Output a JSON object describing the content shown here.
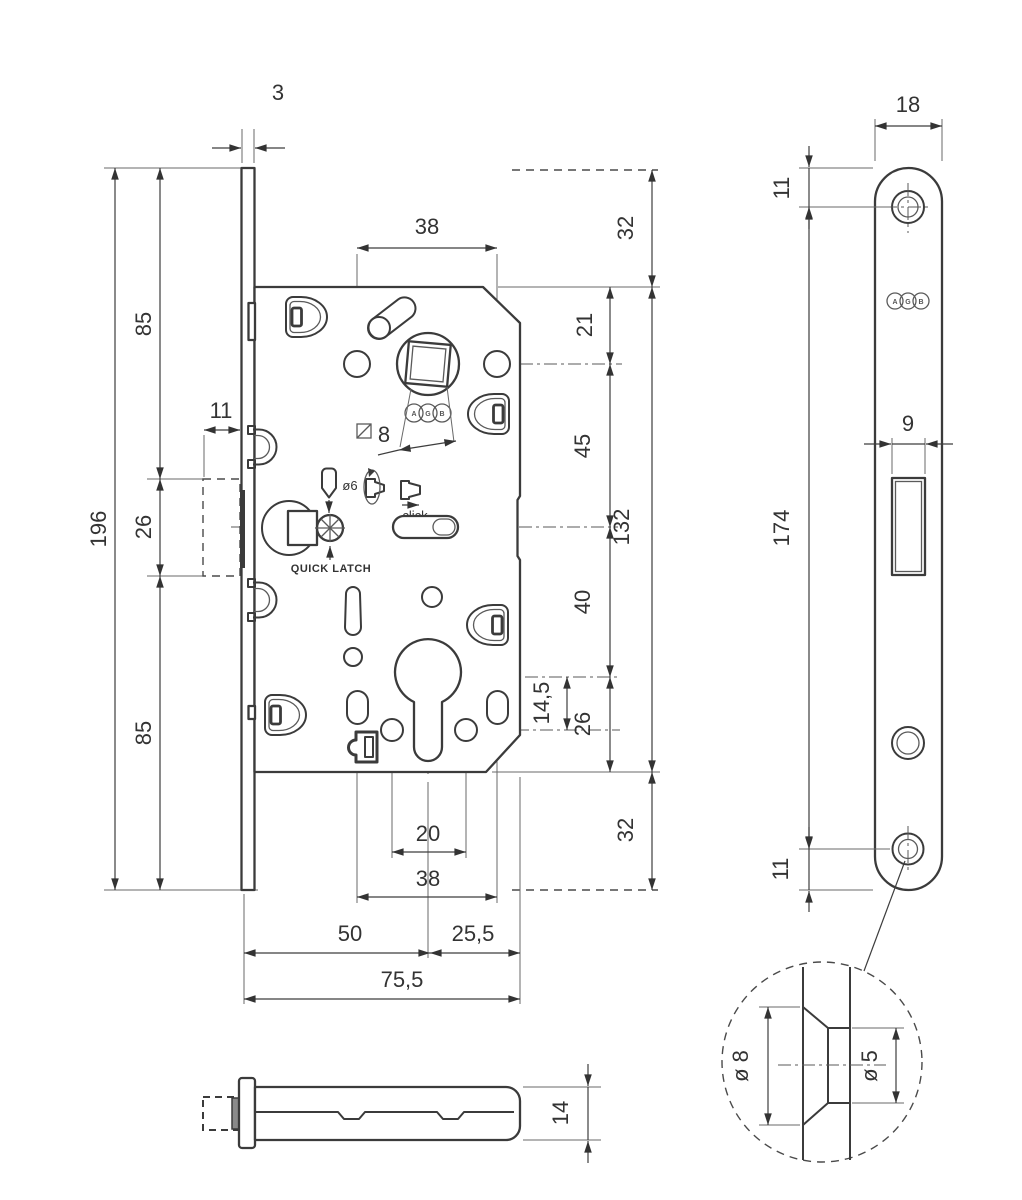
{
  "drawing": {
    "brand_logo_letters": [
      "A",
      "G",
      "B"
    ],
    "front_view": {
      "labels": {
        "quick_latch": "QUICK LATCH",
        "click": "click",
        "pin_diameter": "ø6",
        "spindle_size": "8"
      },
      "dims": {
        "faceplate_thickness": "3",
        "faceplate_height": "196",
        "top_to_strike": "85",
        "strike_height": "26",
        "strike_to_bottom": "85",
        "strike_depth": "11",
        "handle_screws_spacing": "38",
        "above_case": "32",
        "case_top_to_hub": "21",
        "hub_to_magnet": "45",
        "case_height": "132",
        "magnet_to_cylinder": "40",
        "cylinder_to_screws": "14,5",
        "cylinder_to_case_bottom": "26",
        "below_case": "32",
        "cylinder_screws_spacing": "20",
        "slots_spacing": "38",
        "backset": "50",
        "cylinder_to_case_edge": "25,5",
        "case_depth": "75,5"
      }
    },
    "side_view": {
      "dims": {
        "faceplate_width": "18",
        "top_to_screw": "11",
        "screw_centers_distance": "174",
        "latch_window_width": "9",
        "screw_to_bottom": "11"
      }
    },
    "detail_view": {
      "dims": {
        "countersink_outer_diameter": "ø 8",
        "hole_diameter": "ø 5"
      }
    },
    "latch_side_view": {
      "dims": {
        "bolt_height": "14"
      }
    }
  }
}
